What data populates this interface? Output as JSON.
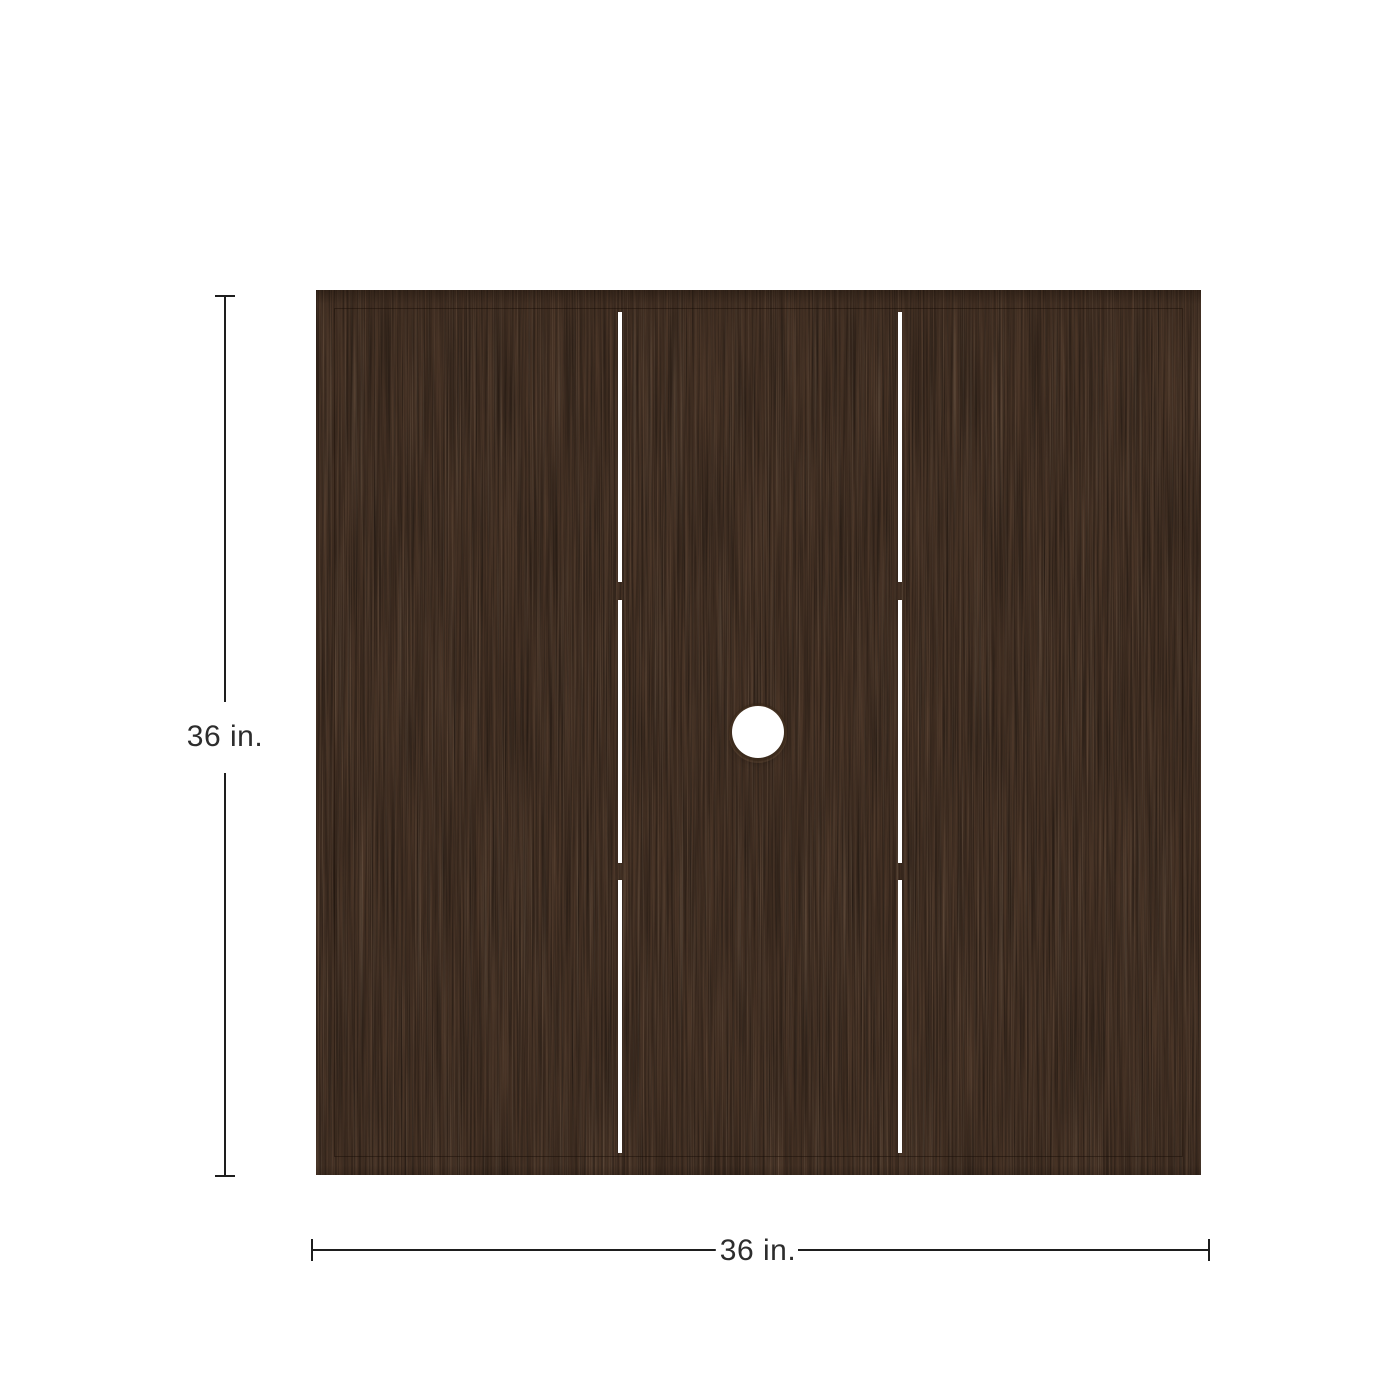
{
  "page": {
    "background_color": "#ffffff"
  },
  "table_top": {
    "shape": "square",
    "slat_count": 3,
    "wood_base_color": "#4a3527",
    "wood_grain_dark_color": "#2a1b0e",
    "wood_grain_light_color": "#8f7252",
    "edge_highlight_color": "#c8ac8a",
    "groove_color": "#160c05",
    "slat_gap_color": "#ffffff",
    "umbrella_hole_color": "#ffffff"
  },
  "dimensions": {
    "line_color": "#1e1e1e",
    "text_color": "#2d2d2d",
    "height": {
      "label": "36 in."
    },
    "width": {
      "label": "36 in."
    }
  }
}
